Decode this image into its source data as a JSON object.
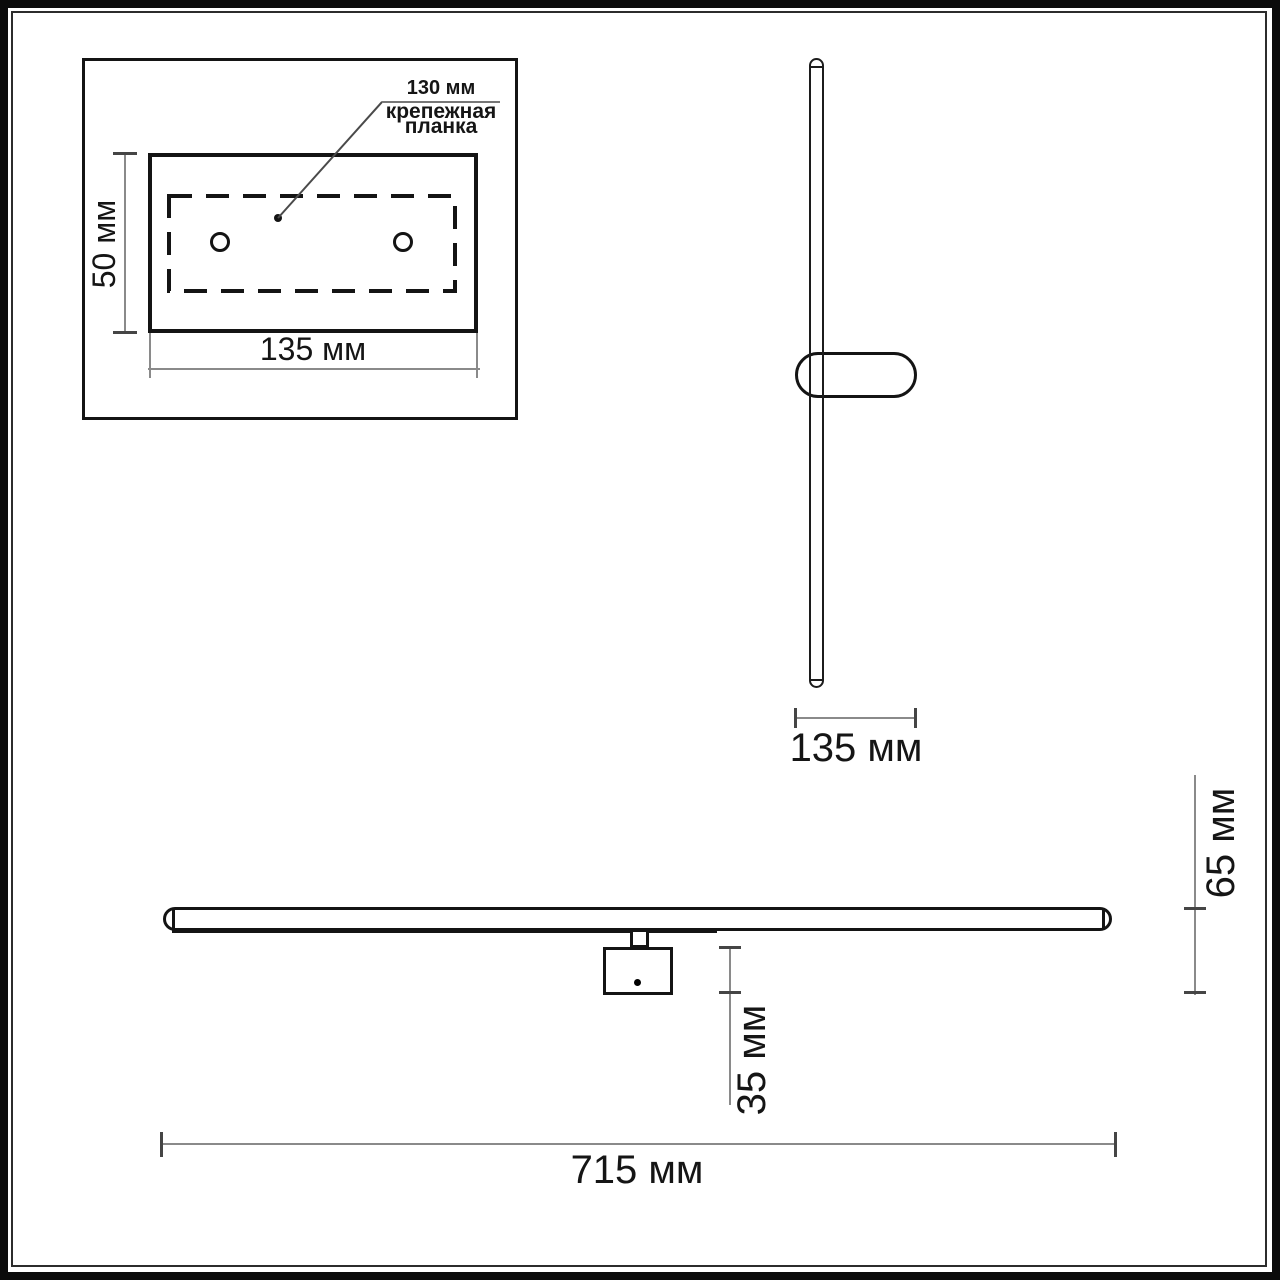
{
  "colors": {
    "line": "#141414",
    "dim_line": "#8a8a8a",
    "tick": "#454545",
    "background": "#ffffff"
  },
  "views": {
    "plate": {
      "leader_value": "130 мм",
      "leader_label_1": "крепежная",
      "leader_label_2": "планка",
      "dim_height": "50 мм",
      "dim_width": "135 мм"
    },
    "side": {
      "dim_width": "135 мм"
    },
    "front": {
      "dim_length": "715 мм",
      "dim_height": "65 мм",
      "dim_offset": "35 мм"
    }
  }
}
